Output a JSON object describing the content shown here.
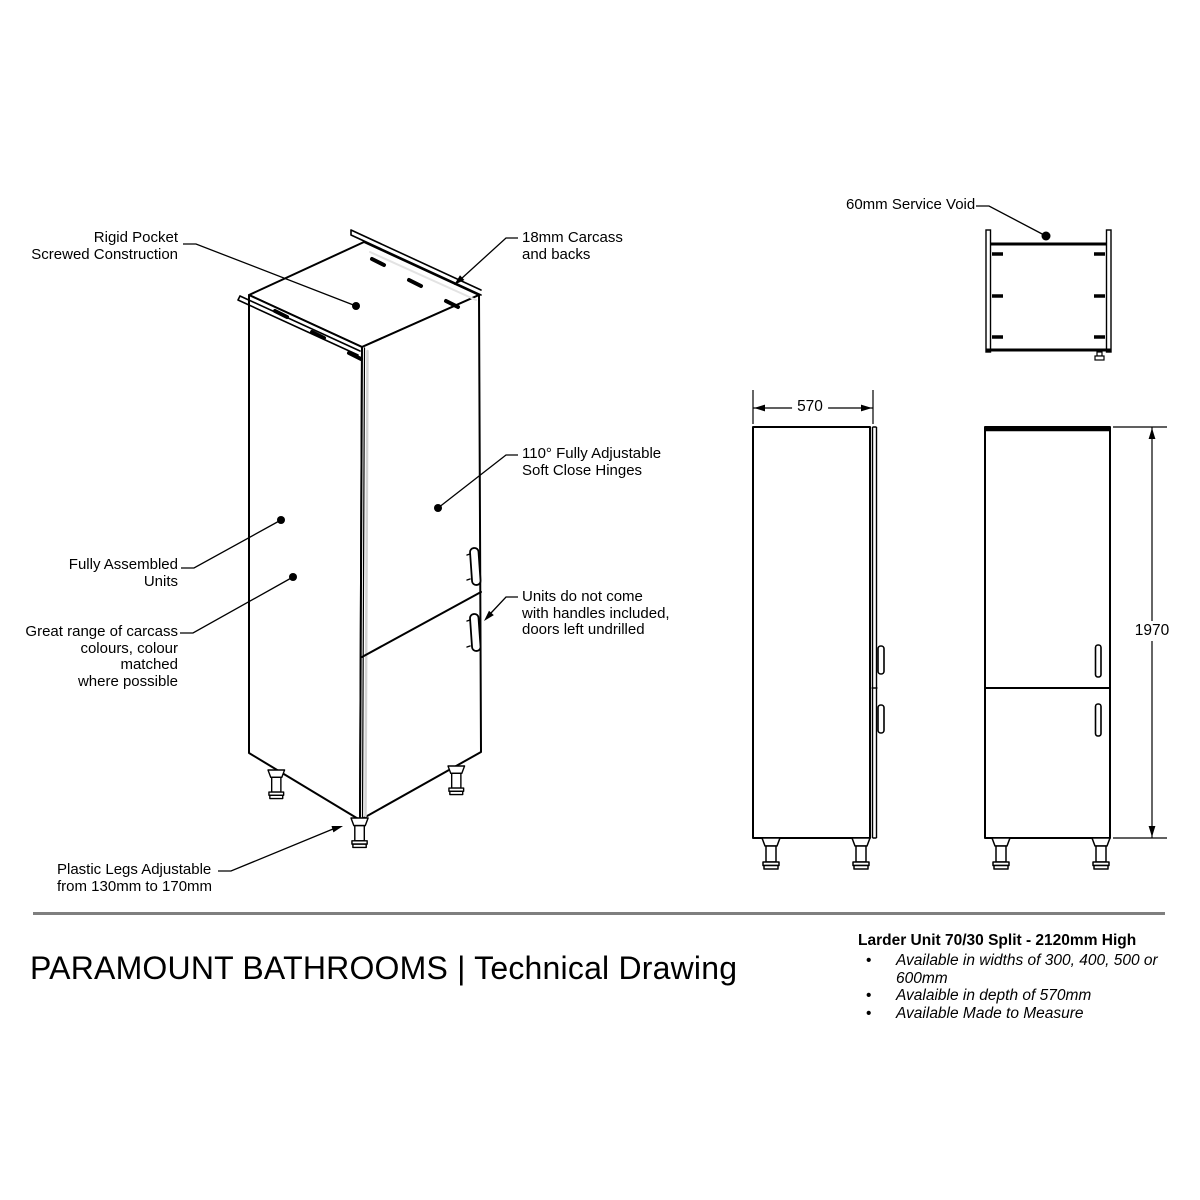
{
  "sheet": {
    "labels": {
      "rigid_pocket": "Rigid Pocket\nScrewed Construction",
      "carcass": "18mm Carcass\nand backs",
      "hinges": "110° Fully Adjustable\nSoft Close Hinges",
      "assembled": "Fully Assembled\nUnits",
      "carcass_colours": "Great range of carcass\ncolours, colour matched\nwhere possible",
      "handles_note": "Units do not come\nwith handles included,\ndoors left undrilled",
      "plastic_legs": "Plastic Legs Adjustable\nfrom 130mm to 170mm",
      "service_void": "60mm Service Void"
    },
    "dimensions": {
      "depth": "570",
      "height": "1970"
    },
    "footer": {
      "title": "PARAMOUNT BATHROOMS | Technical Drawing",
      "product": {
        "heading": "Larder Unit 70/30 Split - 2120mm High",
        "bullets": [
          "Available in widths of 300, 400, 500 or 600mm",
          "Avalaible in depth of 570mm",
          "Available Made to Measure"
        ]
      }
    },
    "colors": {
      "line": "#000000",
      "divider": "#7f7f7f",
      "background": "#ffffff"
    }
  }
}
